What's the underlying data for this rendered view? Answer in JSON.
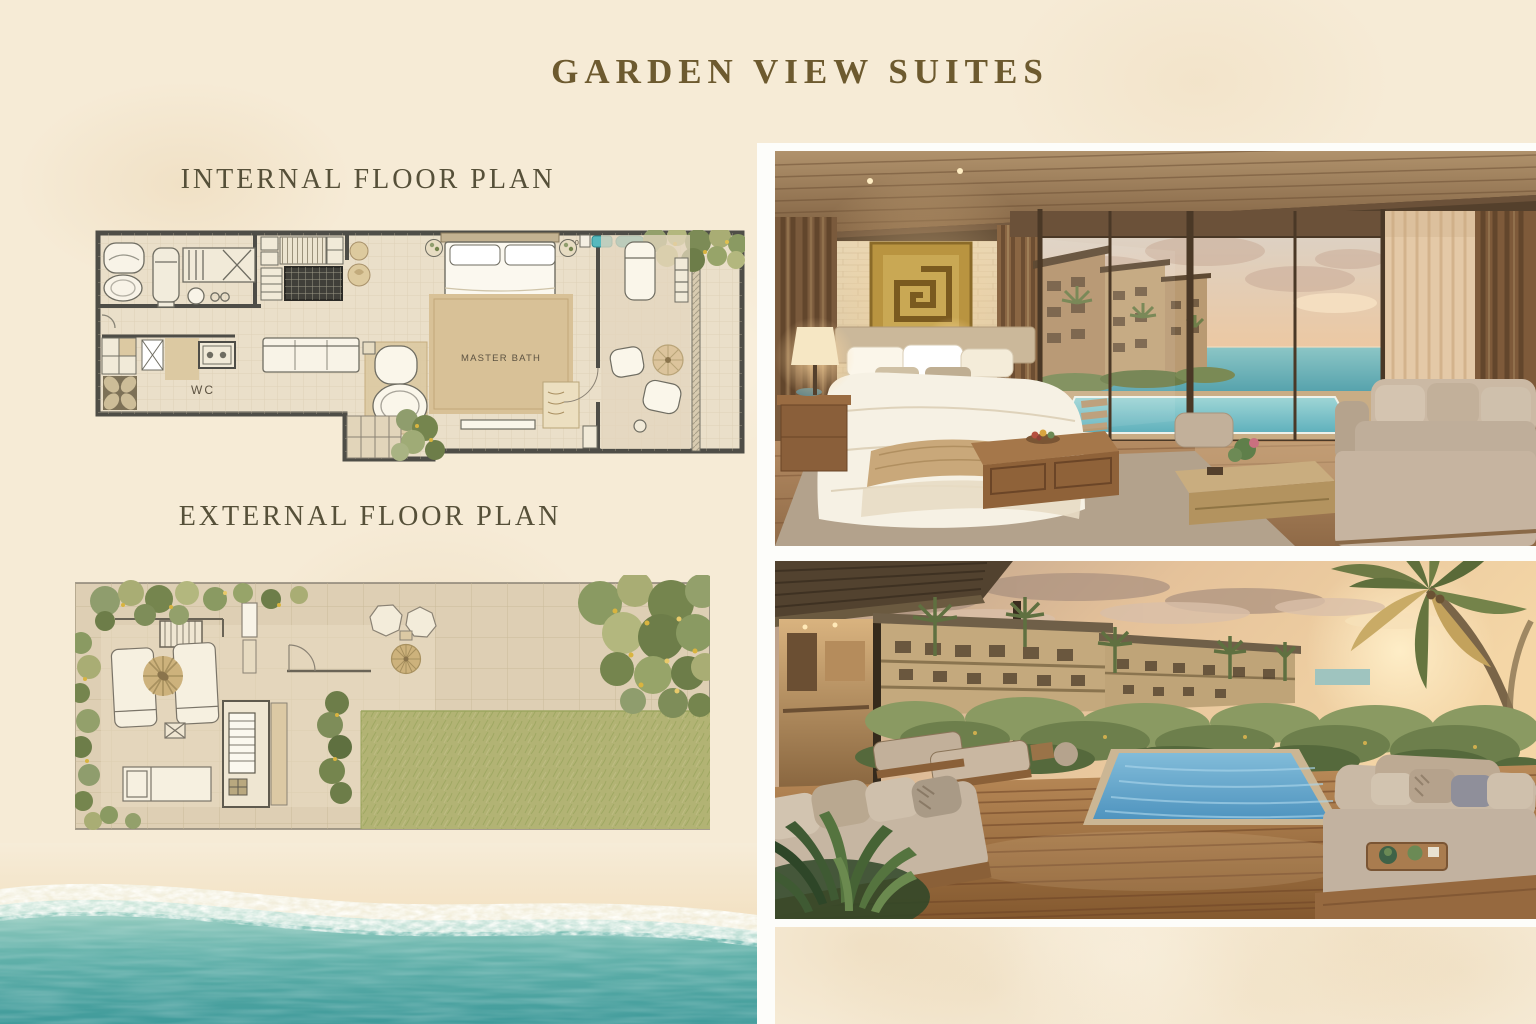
{
  "page": {
    "title": "GARDEN VIEW SUITES"
  },
  "floor_plans": {
    "internal": {
      "label": "INTERNAL FLOOR PLAN",
      "annotations": {
        "master_bath": "MASTER BATH",
        "wc": "WC",
        "corner_mark": "10"
      }
    },
    "external": {
      "label": "EXTERNAL FLOOR PLAN"
    }
  },
  "images": {
    "bedroom_render": {
      "description": "Suite bedroom interior with bed, gold wall art, sliding glass doors, infinity pool and ocean sunset view"
    },
    "deck_render": {
      "description": "Private wooden pool deck with daybeds, plunge pool, palm trees and resort buildings at sunset"
    },
    "beach_aerial": {
      "description": "Aerial beach shoreline with sand, surf foam and turquoise water"
    }
  },
  "colors": {
    "background_cream": "#f6ebd6",
    "title_brown": "#6d5a2f",
    "label_gray_olive": "#565039",
    "plan_wall": "#4e4d47",
    "plan_floor": "#eadfc9",
    "rug_tan": "#d8c197",
    "teal_fixture": "#56b9be",
    "ocean_teal": "#3f9a9a",
    "pool_blue": "#5f9fc9",
    "art_gold": "#c9a854",
    "deck_wood": "#8a5f38",
    "frame_white": "#fdfdfa"
  }
}
